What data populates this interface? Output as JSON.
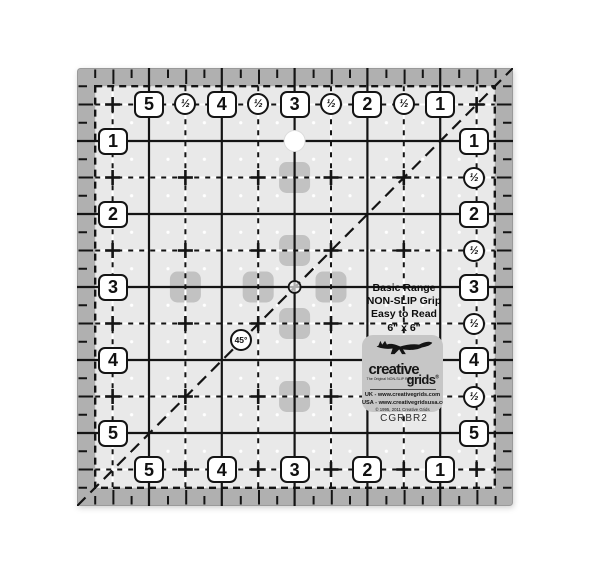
{
  "ruler": {
    "model": "CGRBR2",
    "angle_badge": "45°",
    "half_symbol": "½",
    "plus_symbol": "+",
    "top_numbers": [
      "5",
      "4",
      "3",
      "2",
      "1"
    ],
    "bottom_numbers": [
      "5",
      "4",
      "3",
      "2",
      "1"
    ],
    "left_numbers": [
      "1",
      "2",
      "3",
      "4",
      "5"
    ],
    "right_numbers": [
      "1",
      "2",
      "3",
      "4",
      "5"
    ],
    "info": {
      "line1": "Basic Range",
      "line2": "NON-SLIP Grip",
      "line3": "Easy to Read",
      "line4": "6\" x 6\""
    },
    "logo": {
      "brand_top": "creative",
      "brand_bottom": "grids",
      "reg_mark": "®",
      "tagline": "The Original NON-SLIP Ruler",
      "uk": "UK - www.creativegrids.com",
      "usa": "USA - www.creativegridsusa.com",
      "copyright": "© 1995, 2011 Creative Grids",
      "made": "MADE IN USA"
    },
    "colors": {
      "band": "#b0b0b0",
      "surface": "#e9e9e9",
      "ink": "#141414",
      "patch": "#c2c2c2",
      "logo_bg": "#c6c6c6",
      "dot": "#ffffff"
    }
  }
}
